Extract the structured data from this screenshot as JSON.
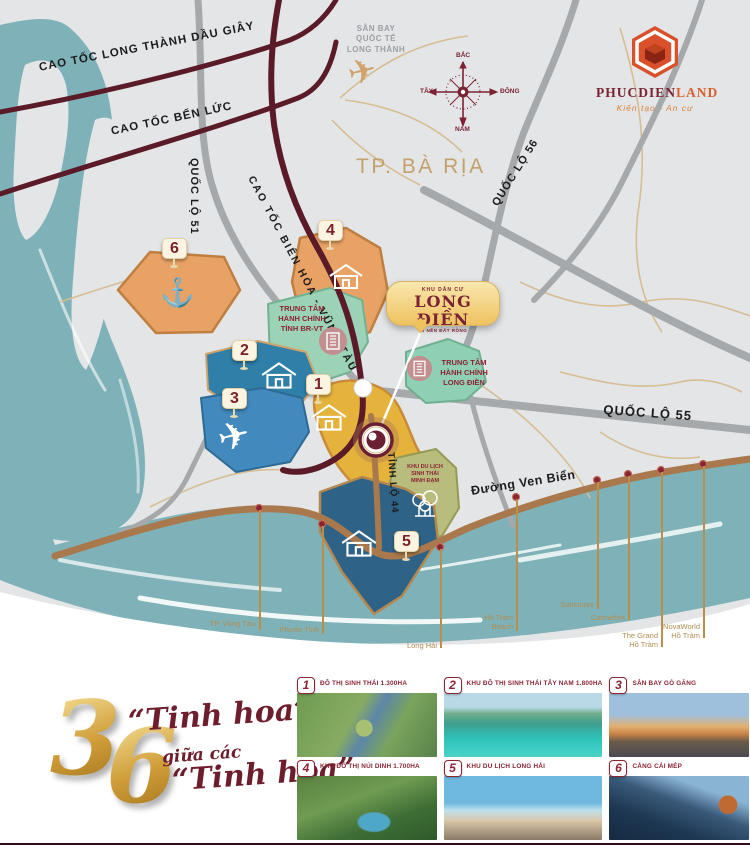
{
  "brand": {
    "name_primary": "PHUCDIEN",
    "name_secondary": "LAND",
    "tagline": "Kiến tạo  -  An cư"
  },
  "compass": {
    "north": "BẮC",
    "south": "NAM",
    "east": "ĐÔNG",
    "west": "TÂY"
  },
  "map": {
    "city_label": "TP. BÀ RỊA",
    "airport_label": "SÂN BAY\nQUỐC TẾ\nLONG THÀNH",
    "roads": {
      "e1": "CAO TỐC LONG THÀNH DẦU GIÂY",
      "e2": "CAO TỐC BẾN LỨC",
      "e3": "CAO TỐC BIÊN HÒA - VŨNG TÀU",
      "ql51": "QUỐC LỘ 51",
      "ql55": "QUỐC LỘ 55",
      "ql56": "QUỐC LỘ 56",
      "tl44": "TỈNH LỘ 44",
      "venbien": "Đường Ven Biển"
    },
    "zones": {
      "brvt_admin": "TRUNG TÂM\nHÀNH CHÍNH\nTỈNH BR-VT",
      "ld_admin": "TRUNG TÂM\nHÀNH CHÍNH\nLONG ĐIỀN",
      "minhdam": "KHU DU LỊCH\nSINH THÁI\nMINH ĐẠM"
    },
    "project_badge": {
      "top": "KHU DÂN CƯ",
      "title": "LONG ĐIỀN",
      "subtitle": "36 NỀN ĐẤT RỒNG"
    },
    "markers": [
      "1",
      "2",
      "3",
      "4",
      "5",
      "6"
    ],
    "coast_labels": [
      {
        "name": "TP. Vũng Tàu"
      },
      {
        "name": "Phước Tỉnh"
      },
      {
        "name": "Long Hải"
      },
      {
        "name": "Hồ Tràm\nBeach"
      },
      {
        "name": "Sanctuary"
      },
      {
        "name": "Carmelina"
      },
      {
        "name": "The Grand\nHồ Tràm"
      },
      {
        "name": "NovaWorld\nHồ Tràm"
      }
    ]
  },
  "tagline_art": {
    "digit1": "3",
    "digit2": "6",
    "line1": "“Tinh hoa”",
    "line2": "giữa các",
    "line3": "“Tinh hoa”"
  },
  "legend": {
    "items": [
      {
        "num": "1",
        "label": "ĐÔ THỊ SINH THÁI 1.300HA"
      },
      {
        "num": "2",
        "label": "KHU ĐÔ THỊ SINH THÁI TÂY NAM 1.800HA"
      },
      {
        "num": "3",
        "label": "SÂN BAY GÒ GĂNG"
      },
      {
        "num": "4",
        "label": "KHU ĐÔ THỊ NÚI DINH 1.700HA"
      },
      {
        "num": "5",
        "label": "KHU DU LỊCH LONG HẢI"
      },
      {
        "num": "6",
        "label": "CẢNG CÁI MÉP"
      }
    ]
  },
  "colors": {
    "land": "#e4e5e7",
    "water": "#7fb2b8",
    "expressway": "#5a1a28",
    "road_major": "#a6a9ab",
    "road_minor": "#d6bd92",
    "coast_road": "#a9794d",
    "accent_maroon": "#7a2333",
    "gold": "#d9a43b",
    "orange_zone": "#e9a266",
    "teal_zone": "#2f7fa8",
    "blue_zone": "#4289bd",
    "navy_zone": "#2e6287",
    "green_zone": "#9cd2b6",
    "olive_zone": "#b8bd7e",
    "yellow_zone": "#e5b33c"
  }
}
